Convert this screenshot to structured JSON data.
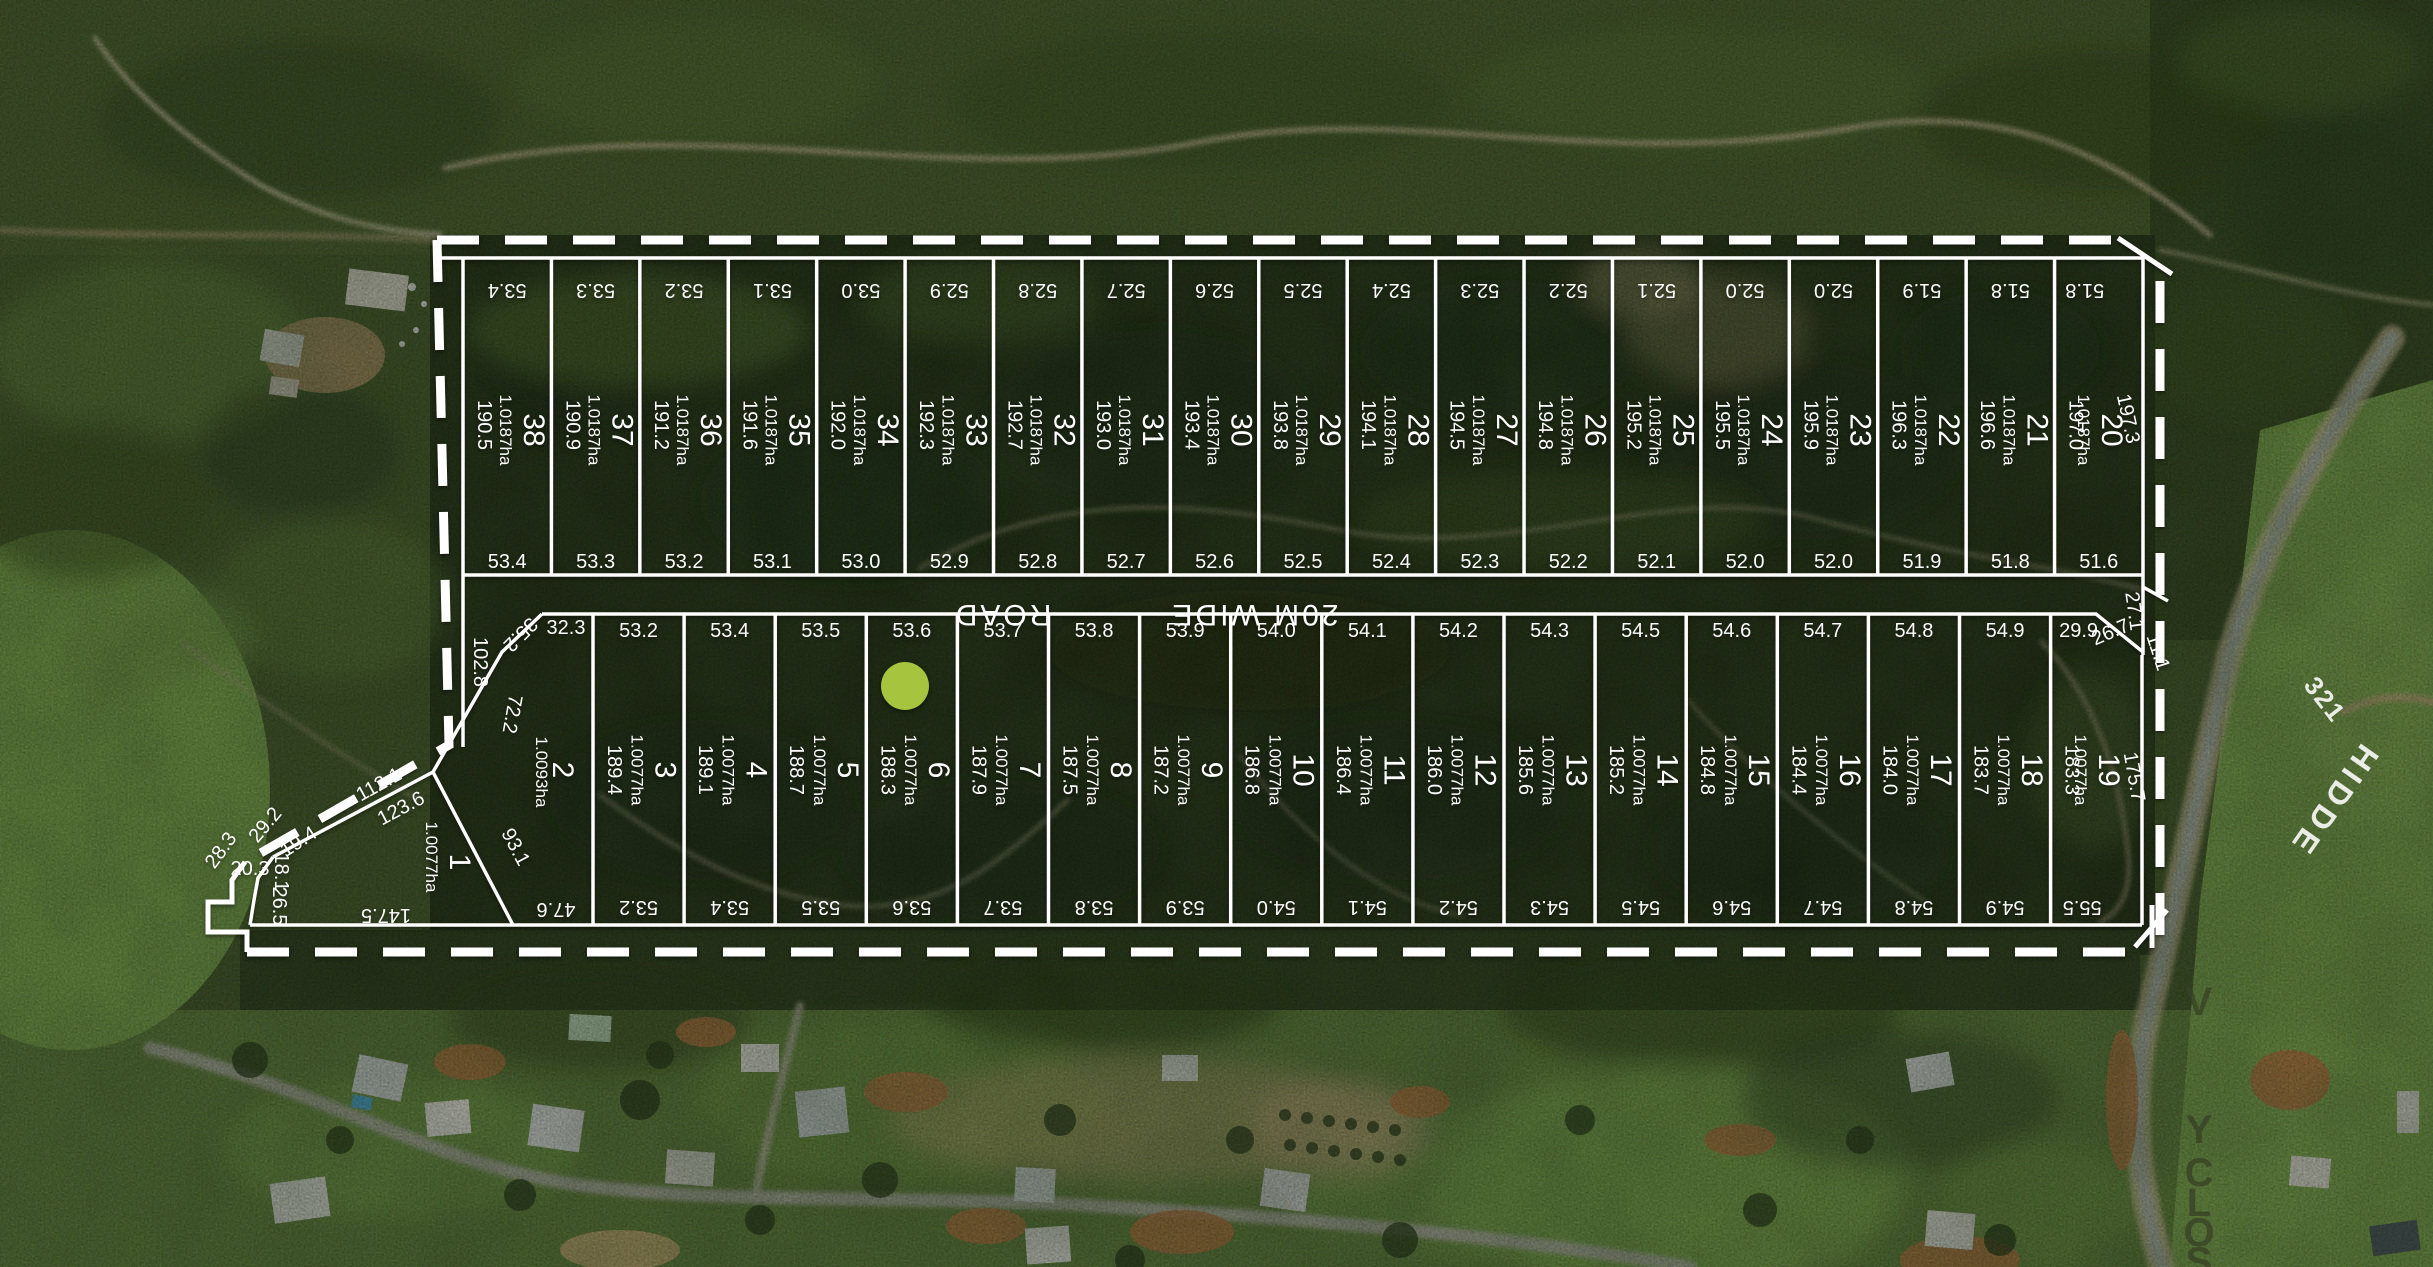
{
  "plan": {
    "road_label": {
      "part1": "20M WIDE",
      "part2": "ROAD"
    },
    "rows": {
      "top": [
        {
          "lot": "38",
          "area": "1.0187ha",
          "side": "190.5",
          "top": "53.4",
          "bottom": "53.4"
        },
        {
          "lot": "37",
          "area": "1.0187ha",
          "side": "190.9",
          "top": "53.3",
          "bottom": "53.3"
        },
        {
          "lot": "36",
          "area": "1.0187ha",
          "side": "191.2",
          "top": "53.2",
          "bottom": "53.2"
        },
        {
          "lot": "35",
          "area": "1.0187ha",
          "side": "191.6",
          "top": "53.1",
          "bottom": "53.1"
        },
        {
          "lot": "34",
          "area": "1.0187ha",
          "side": "192.0",
          "top": "53.0",
          "bottom": "53.0"
        },
        {
          "lot": "33",
          "area": "1.0187ha",
          "side": "192.3",
          "top": "52.9",
          "bottom": "52.9"
        },
        {
          "lot": "32",
          "area": "1.0187ha",
          "side": "192.7",
          "top": "52.8",
          "bottom": "52.8"
        },
        {
          "lot": "31",
          "area": "1.0187ha",
          "side": "193.0",
          "top": "52.7",
          "bottom": "52.7"
        },
        {
          "lot": "30",
          "area": "1.0187ha",
          "side": "193.4",
          "top": "52.6",
          "bottom": "52.6"
        },
        {
          "lot": "29",
          "area": "1.0187ha",
          "side": "193.8",
          "top": "52.5",
          "bottom": "52.5"
        },
        {
          "lot": "28",
          "area": "1.0187ha",
          "side": "194.1",
          "top": "52.4",
          "bottom": "52.4"
        },
        {
          "lot": "27",
          "area": "1.0187ha",
          "side": "194.5",
          "top": "52.3",
          "bottom": "52.3"
        },
        {
          "lot": "26",
          "area": "1.0187ha",
          "side": "194.8",
          "top": "52.2",
          "bottom": "52.2"
        },
        {
          "lot": "25",
          "area": "1.0187ha",
          "side": "195.2",
          "top": "52.1",
          "bottom": "52.1"
        },
        {
          "lot": "24",
          "area": "1.0187ha",
          "side": "195.5",
          "top": "52.0",
          "bottom": "52.0"
        },
        {
          "lot": "23",
          "area": "1.0187ha",
          "side": "195.9",
          "top": "52.0",
          "bottom": "52.0"
        },
        {
          "lot": "22",
          "area": "1.0187ha",
          "side": "196.3",
          "top": "51.9",
          "bottom": "51.9"
        },
        {
          "lot": "21",
          "area": "1.0187ha",
          "side": "196.6",
          "top": "51.8",
          "bottom": "51.8"
        },
        {
          "lot": "20",
          "area": "1.0187ha",
          "side": "197.0",
          "side_right": "197.3",
          "top": "51.8",
          "bottom": "51.6"
        }
      ],
      "bottom": [
        {
          "lot": "3",
          "area": "1.0077ha",
          "side": "189.4",
          "top": "53.2",
          "bottom": "53.2"
        },
        {
          "lot": "4",
          "area": "1.0077ha",
          "side": "189.1",
          "top": "53.4",
          "bottom": "53.4"
        },
        {
          "lot": "5",
          "area": "1.0077ha",
          "side": "188.7",
          "top": "53.5",
          "bottom": "53.5"
        },
        {
          "lot": "6",
          "area": "1.0077ha",
          "side": "188.3",
          "top": "53.6",
          "bottom": "53.6"
        },
        {
          "lot": "7",
          "area": "1.0077ha",
          "side": "187.9",
          "top": "53.7",
          "bottom": "53.7"
        },
        {
          "lot": "8",
          "area": "1.0077ha",
          "side": "187.5",
          "top": "53.8",
          "bottom": "53.8"
        },
        {
          "lot": "9",
          "area": "1.0077ha",
          "side": "187.2",
          "top": "53.9",
          "bottom": "53.9"
        },
        {
          "lot": "10",
          "area": "1.0077ha",
          "side": "186.8",
          "top": "54.0",
          "bottom": "54.0"
        },
        {
          "lot": "11",
          "area": "1.0077ha",
          "side": "186.4",
          "top": "54.1",
          "bottom": "54.1"
        },
        {
          "lot": "12",
          "area": "1.0077ha",
          "side": "186.0",
          "top": "54.2",
          "bottom": "54.2"
        },
        {
          "lot": "13",
          "area": "1.0077ha",
          "side": "185.6",
          "top": "54.3",
          "bottom": "54.3"
        },
        {
          "lot": "14",
          "area": "1.0077ha",
          "side": "185.2",
          "top": "54.5",
          "bottom": "54.5"
        },
        {
          "lot": "15",
          "area": "1.0077ha",
          "side": "184.8",
          "top": "54.6",
          "bottom": "54.6"
        },
        {
          "lot": "16",
          "area": "1.0077ha",
          "side": "184.4",
          "top": "54.7",
          "bottom": "54.7"
        },
        {
          "lot": "17",
          "area": "1.0077ha",
          "side": "184.0",
          "top": "54.8",
          "bottom": "54.8"
        },
        {
          "lot": "18",
          "area": "1.0077ha",
          "side": "183.7",
          "top": "54.9",
          "bottom": "54.9"
        },
        {
          "lot": "19",
          "area": "1.0077ha",
          "side": "183.3",
          "side_right": "175.7",
          "top": "29.9",
          "bottom": "55.5"
        }
      ]
    },
    "lot1": {
      "num": "1",
      "area": "1.0077ha",
      "bottom_dim": "147.5"
    },
    "lot2": {
      "num": "2",
      "area": "1.0093ha",
      "top_dim": "32.3",
      "bottom_dim": "47.6"
    },
    "boundary_labels": [
      {
        "text": "102.8",
        "x": 474,
        "y": 662,
        "rot": 90
      },
      {
        "text": "72.2",
        "x": 506,
        "y": 713,
        "rot": 100
      },
      {
        "text": "93.1",
        "x": 510,
        "y": 850,
        "rot": 62
      },
      {
        "text": "35.2",
        "x": 516,
        "y": 630,
        "rot": 135
      },
      {
        "text": "112.1",
        "x": 382,
        "y": 790,
        "rot": -29
      },
      {
        "text": "123.6",
        "x": 404,
        "y": 814,
        "rot": -28
      },
      {
        "text": "19.4",
        "x": 302,
        "y": 847,
        "rot": -33
      },
      {
        "text": "29.2",
        "x": 270,
        "y": 829,
        "rot": -50
      },
      {
        "text": "28.3",
        "x": 226,
        "y": 854,
        "rot": -54
      },
      {
        "text": "20.3",
        "x": 250,
        "y": 875,
        "rot": 0
      },
      {
        "text": "18.1",
        "x": 275,
        "y": 872,
        "rot": 90
      },
      {
        "text": "26.5",
        "x": 273,
        "y": 906,
        "rot": 90
      },
      {
        "text": "27.1",
        "x": 2128,
        "y": 612,
        "rot": 82
      },
      {
        "text": "26.7",
        "x": 2113,
        "y": 638,
        "rot": -23
      },
      {
        "text": "11.1",
        "x": 2152,
        "y": 654,
        "rot": 72
      }
    ],
    "street": {
      "number": "321",
      "name_diagonal": "HIDDE",
      "name_vertical": [
        "V",
        "Y",
        "C",
        "L",
        "O",
        "S"
      ]
    },
    "marker": {
      "x": 905,
      "y": 686,
      "r": 24,
      "color": "#a6c43d"
    },
    "colors": {
      "overlay_lines": "#ffffff",
      "marker": "#a6c43d",
      "street_text": "#3a4227",
      "forest_dark": "#222e15",
      "paddock_green": "#7ba44c"
    }
  }
}
